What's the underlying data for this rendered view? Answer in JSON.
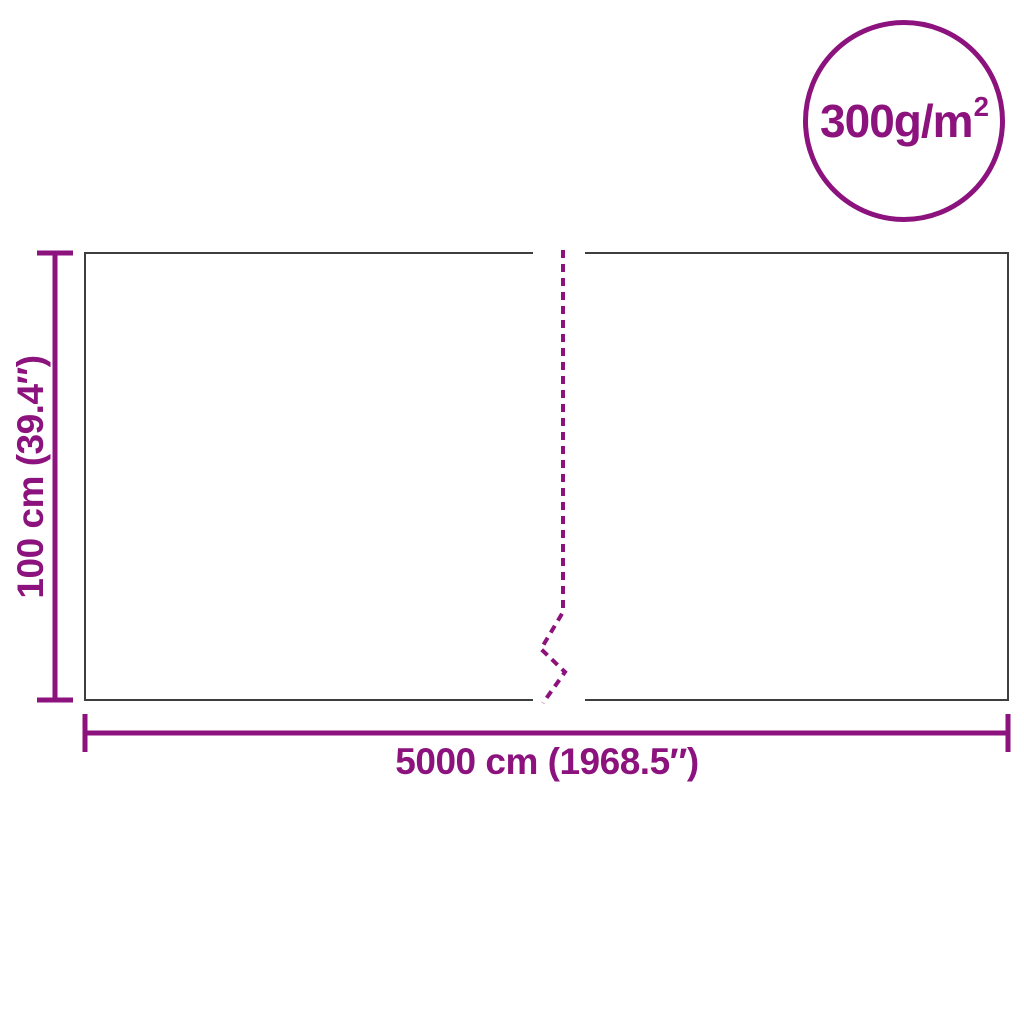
{
  "colors": {
    "accent": "#8C127D",
    "outline": "#3E3E3E",
    "background": "#FFFFFF"
  },
  "badge": {
    "label": "300g/m",
    "superscript": "2"
  },
  "dimensions": {
    "height_label": "100 cm (39.4″)",
    "width_label": "5000 cm (1968.5″)"
  }
}
